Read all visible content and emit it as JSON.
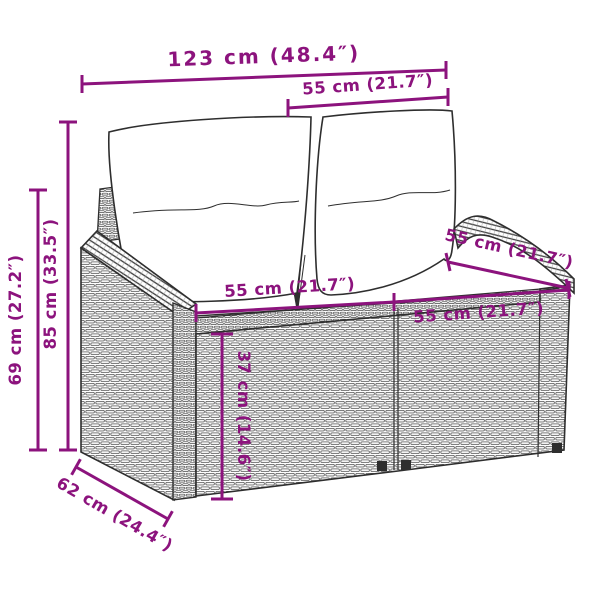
{
  "page": {
    "background_color": "#ffffff",
    "description": "Product dimension line-drawing of a poly rattan 2-seater garden sofa with white back and seat cushions, annotated with magenta measurement lines"
  },
  "diagram": {
    "accent_color": "#8C137D",
    "outline_color": "#2e2e2e",
    "product": "rattan-2-seater-garden-sofa",
    "dimensions": {
      "total_width": "123 cm (48.4″)",
      "back_cushion_width": "55 cm (21.7″)",
      "total_height": "85 cm (33.5″)",
      "frame_height": "69 cm (27.2″)",
      "seat_width_left": "55 cm (21.7″)",
      "seat_width_right": "55 cm (21.7″)",
      "seat_depth": "55 cm (21.7″)",
      "seat_height": "37 cm (14.6″)",
      "total_depth": "62 cm (24.4″)"
    }
  }
}
